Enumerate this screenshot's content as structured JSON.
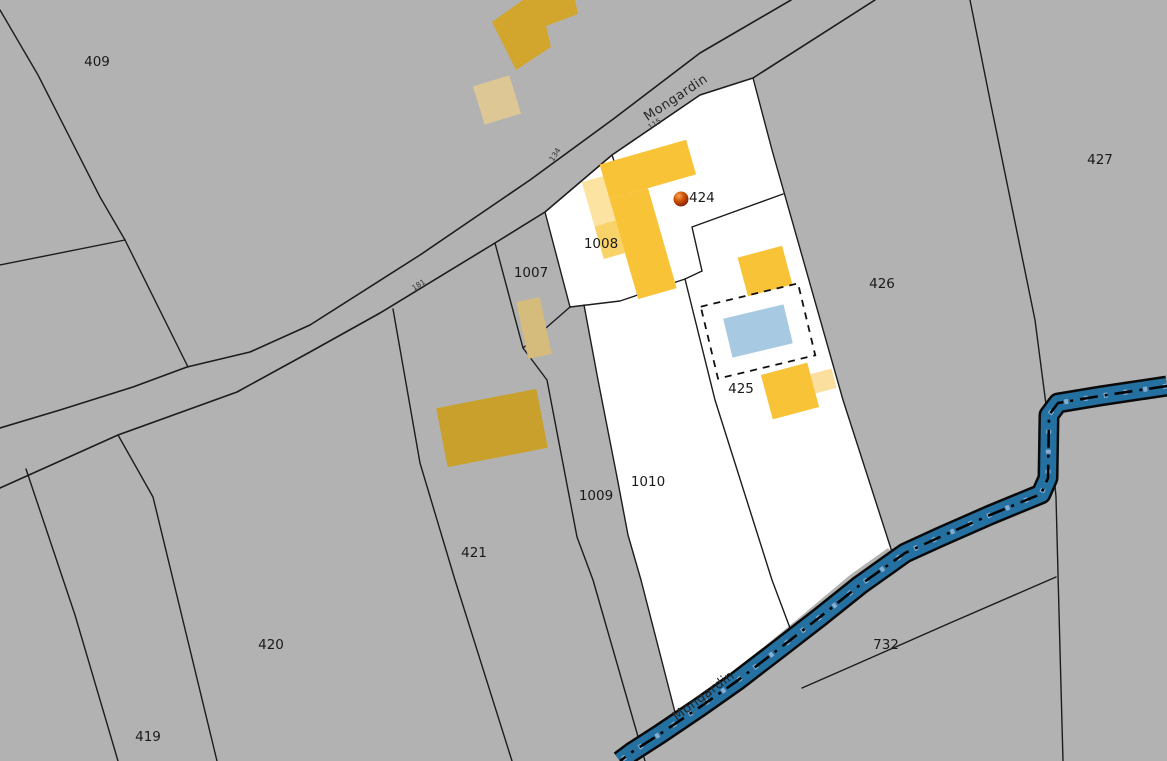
{
  "map": {
    "title": "Cadastral map",
    "colors": {
      "background_gray": "#b2b2b2",
      "highlight_white": "#ffffff",
      "boundary_line": "#1c1c1c",
      "building_yellow": "#f9c338",
      "building_yellow_light": "#fce3a1",
      "building_yellow_mid": "#f9d269",
      "building_mustard": "#d2a62c",
      "building_mustard_dark": "#c9a02b",
      "building_tan": "#d5bc7c",
      "building_tan_pale": "#dcc795",
      "pool_blue": "#a7c9e2",
      "stream_blue": "#2470a0",
      "marker_red": "#d35400"
    },
    "parcels": {
      "p409": {
        "label": "409",
        "highlighted": false
      },
      "p419": {
        "label": "419",
        "highlighted": false
      },
      "p420": {
        "label": "420",
        "highlighted": false
      },
      "p421": {
        "label": "421",
        "highlighted": false
      },
      "p424": {
        "label": "424",
        "highlighted": true
      },
      "p425": {
        "label": "425",
        "highlighted": true
      },
      "p426": {
        "label": "426",
        "highlighted": false
      },
      "p427": {
        "label": "427",
        "highlighted": false
      },
      "p732": {
        "label": "732",
        "highlighted": false
      },
      "p1007": {
        "label": "1007",
        "highlighted": false
      },
      "p1008": {
        "label": "1008",
        "highlighted": true
      },
      "p1009": {
        "label": "1009",
        "highlighted": false
      },
      "p1010": {
        "label": "1010",
        "highlighted": true
      }
    },
    "roads": {
      "road_top": {
        "name": "Mongardin"
      },
      "stream_bottom": {
        "name": "Mongardin"
      }
    },
    "road_numbers": {
      "n115": {
        "label": "115"
      },
      "n134": {
        "label": "134"
      },
      "n181": {
        "label": "181"
      }
    },
    "marker": {
      "label": "424"
    }
  }
}
